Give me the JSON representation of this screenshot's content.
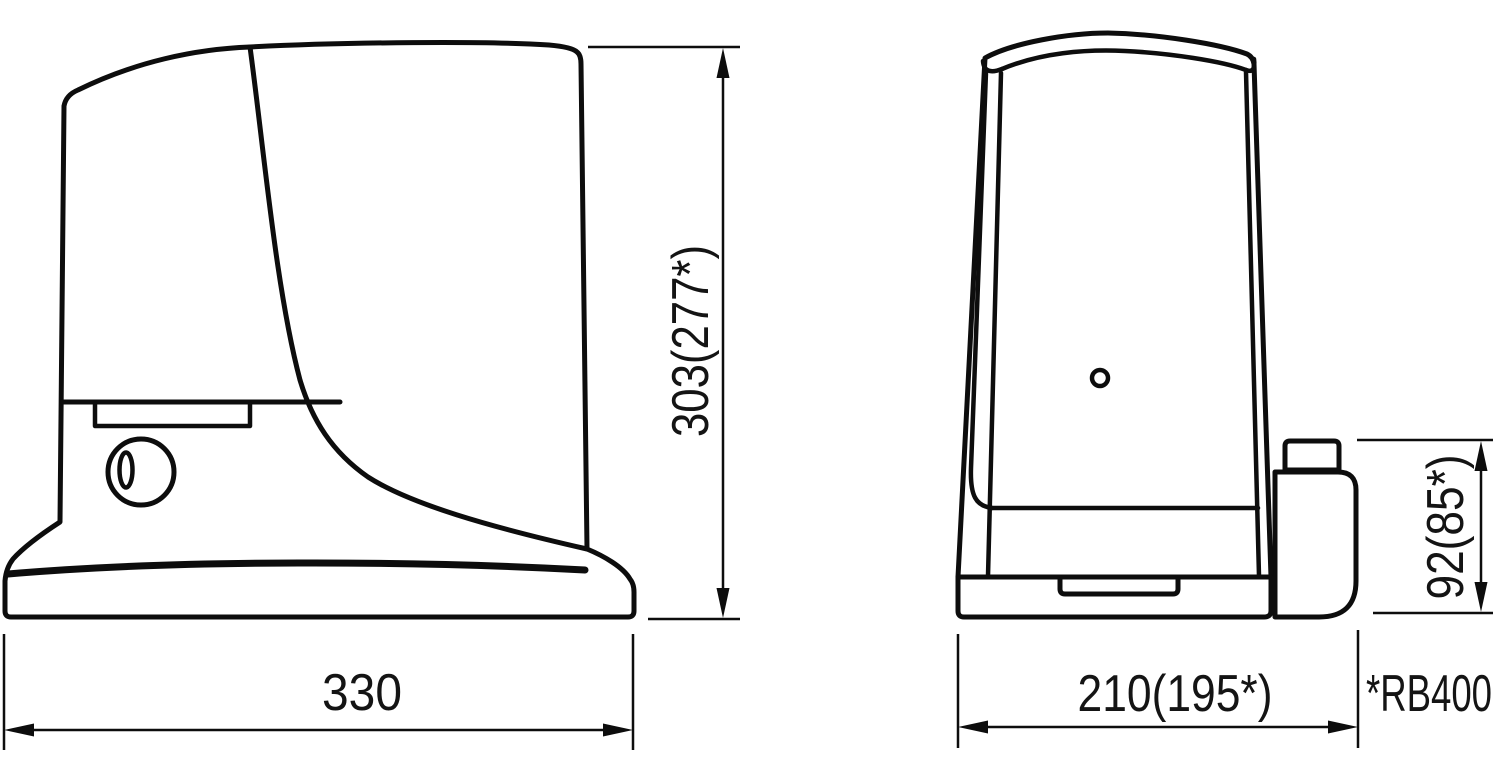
{
  "colors": {
    "line": "#0d0d0d",
    "background": "#ffffff",
    "text": "#141414"
  },
  "drawing": {
    "type": "technical-dimension-drawing",
    "views": [
      {
        "id": "side-view",
        "description": "gate motor side elevation"
      },
      {
        "id": "front-view",
        "description": "gate motor front elevation with release housing"
      }
    ],
    "dimensions": {
      "side_height": "303(277*)",
      "side_width": "330",
      "front_width": "210(195*)",
      "release_height": "92(85*)"
    },
    "note": "*RB400"
  }
}
